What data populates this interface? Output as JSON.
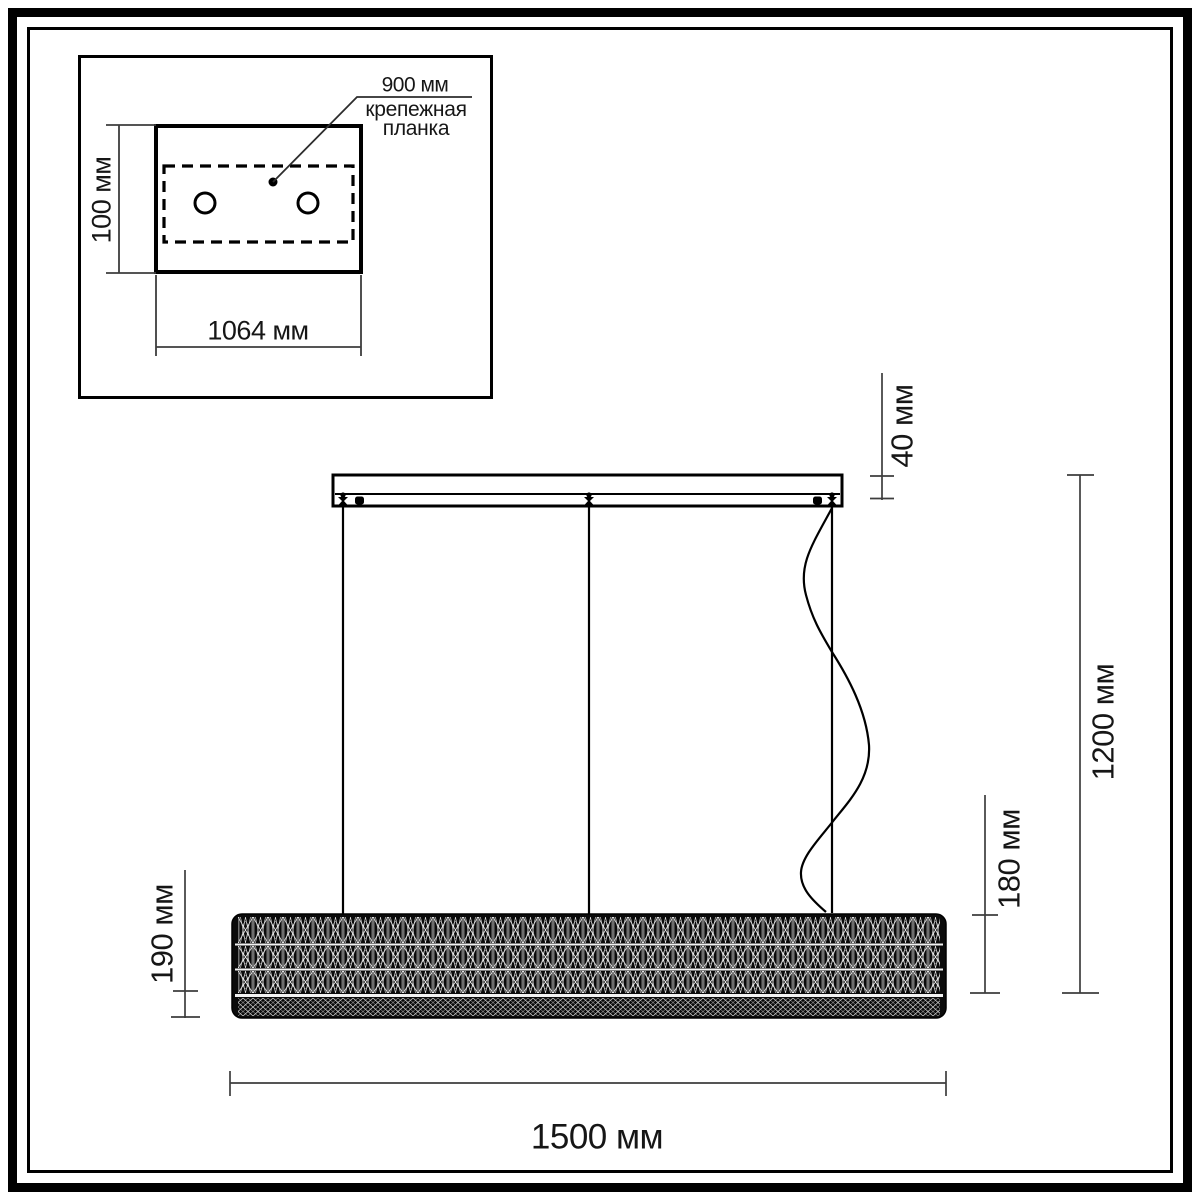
{
  "inset": {
    "callout_value": "900 мм",
    "callout_label_line1": "крепежная",
    "callout_label_line2": "планка",
    "plate_height_dim": "100 мм",
    "plate_width_dim": "1064 мм"
  },
  "main": {
    "canopy_height_dim": "40 мм",
    "overall_height_dim": "1200 мм",
    "suspension_height_dim": "180 мм",
    "fixture_height_dim": "190 мм",
    "fixture_length_dim": "1500 мм"
  },
  "colors": {
    "ink": "#000000",
    "dim_line": "#3d3d3d",
    "background": "#ffffff"
  }
}
